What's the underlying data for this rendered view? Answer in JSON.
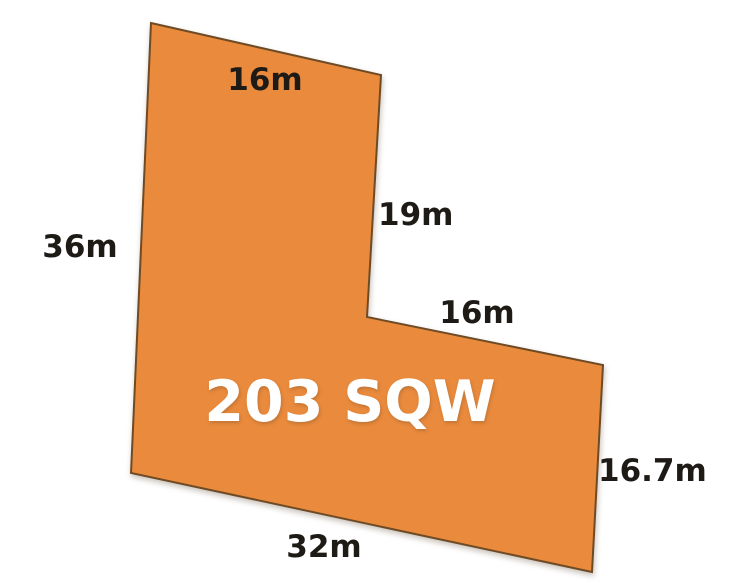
{
  "diagram": {
    "type": "property-lot-plan",
    "lot_label": "203 SQW",
    "dimensions": {
      "top": "16m",
      "right_upper": "19m",
      "left": "36m",
      "notch": "16m",
      "right_lower": "16.7m",
      "bottom": "32m"
    },
    "colors": {
      "lot_fill": "#E98A3D",
      "lot_stroke": "#6E4B25",
      "dimension_text": "#1E1A15",
      "lot_label_text": "#FFFFFF",
      "background": "#FFFFFF"
    }
  }
}
